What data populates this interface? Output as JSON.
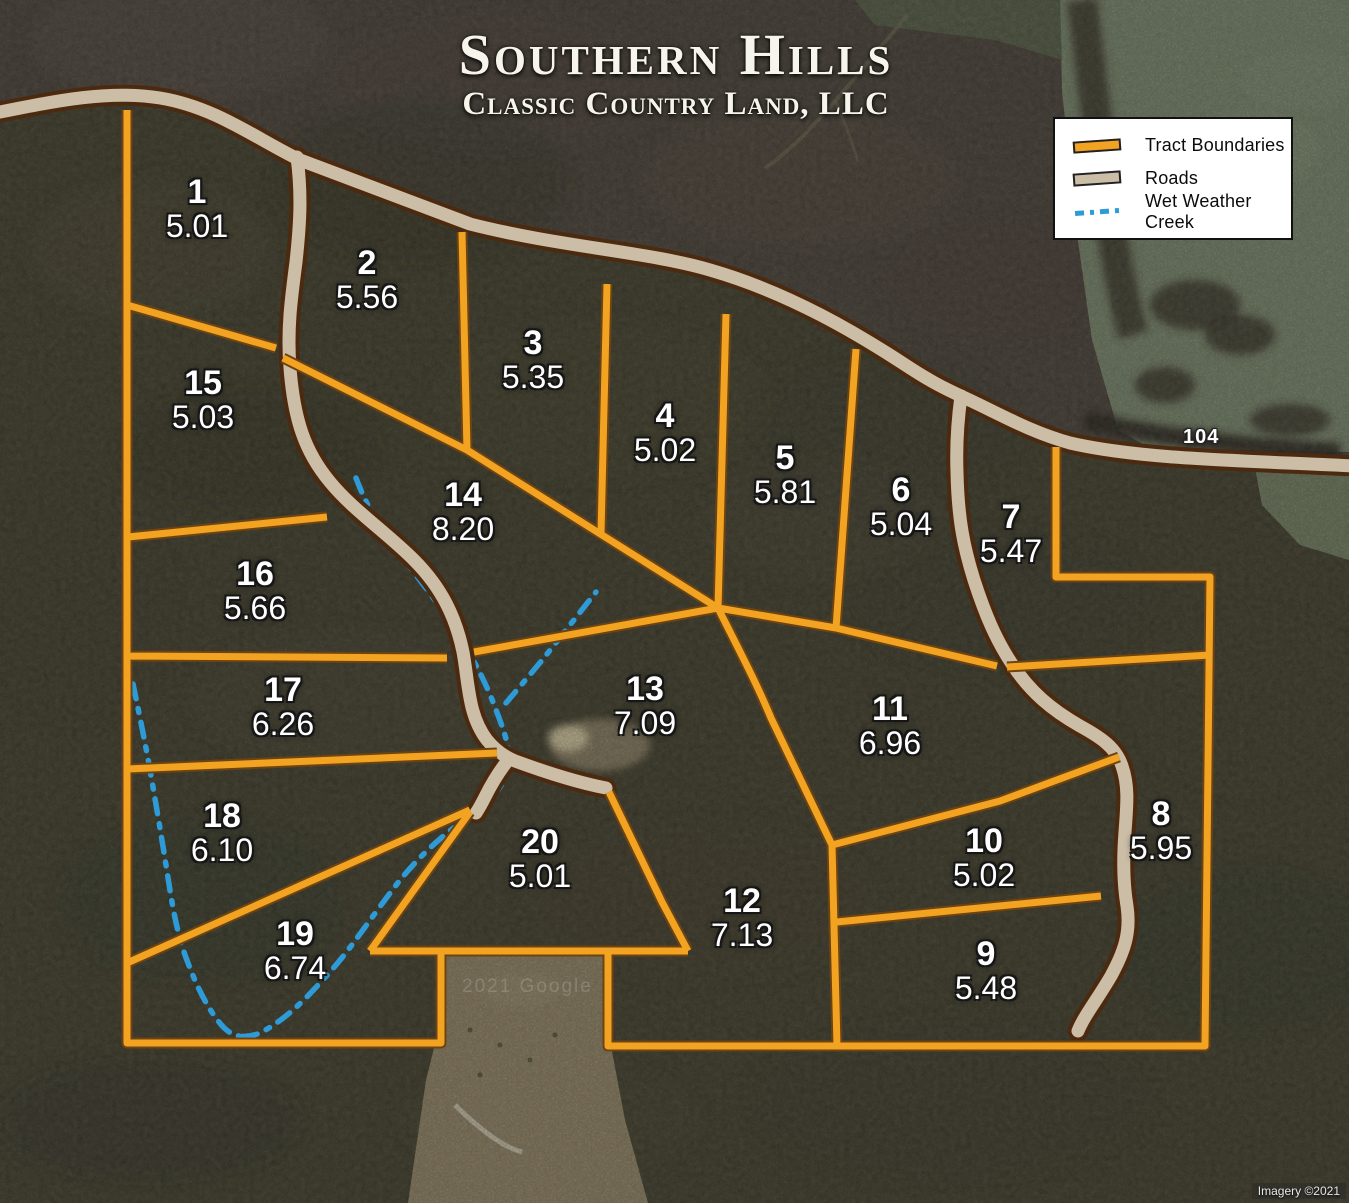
{
  "title": {
    "main": "Southern Hills",
    "subtitle": "Classic Country Land, LLC"
  },
  "legend": {
    "items": [
      {
        "id": "tract-boundaries",
        "label": "Tract Boundaries",
        "color": "#F2A321"
      },
      {
        "id": "roads",
        "label": "Roads",
        "color": "#CBBDA6"
      },
      {
        "id": "wet-weather-creek",
        "label": "Wet Weather Creek",
        "color": "#2E9BD6"
      }
    ]
  },
  "map": {
    "road_label": "104",
    "watermark": "2021 Google",
    "credit": "Imagery ©2021"
  },
  "tracts": [
    {
      "number": "1",
      "acres": "5.01",
      "x": 197,
      "y": 196
    },
    {
      "number": "2",
      "acres": "5.56",
      "x": 367,
      "y": 267
    },
    {
      "number": "3",
      "acres": "5.35",
      "x": 533,
      "y": 347
    },
    {
      "number": "4",
      "acres": "5.02",
      "x": 665,
      "y": 420
    },
    {
      "number": "5",
      "acres": "5.81",
      "x": 785,
      "y": 462
    },
    {
      "number": "6",
      "acres": "5.04",
      "x": 901,
      "y": 494
    },
    {
      "number": "7",
      "acres": "5.47",
      "x": 1011,
      "y": 521
    },
    {
      "number": "8",
      "acres": "5.95",
      "x": 1161,
      "y": 818
    },
    {
      "number": "9",
      "acres": "5.48",
      "x": 986,
      "y": 958
    },
    {
      "number": "10",
      "acres": "5.02",
      "x": 984,
      "y": 845
    },
    {
      "number": "11",
      "acres": "6.96",
      "x": 890,
      "y": 713
    },
    {
      "number": "12",
      "acres": "7.13",
      "x": 742,
      "y": 905
    },
    {
      "number": "13",
      "acres": "7.09",
      "x": 645,
      "y": 693
    },
    {
      "number": "14",
      "acres": "8.20",
      "x": 463,
      "y": 499
    },
    {
      "number": "15",
      "acres": "5.03",
      "x": 203,
      "y": 387
    },
    {
      "number": "16",
      "acres": "5.66",
      "x": 255,
      "y": 578
    },
    {
      "number": "17",
      "acres": "6.26",
      "x": 283,
      "y": 694
    },
    {
      "number": "18",
      "acres": "6.10",
      "x": 222,
      "y": 820
    },
    {
      "number": "19",
      "acres": "6.74",
      "x": 295,
      "y": 938
    },
    {
      "number": "20",
      "acres": "5.01",
      "x": 540,
      "y": 846
    }
  ],
  "colors": {
    "tract_boundary": "#F2A321",
    "tract_boundary_casing": "#6E4312",
    "road_fill": "#CBBDA6",
    "road_casing": "#4C2A10",
    "creek": "#2E9BD6"
  }
}
